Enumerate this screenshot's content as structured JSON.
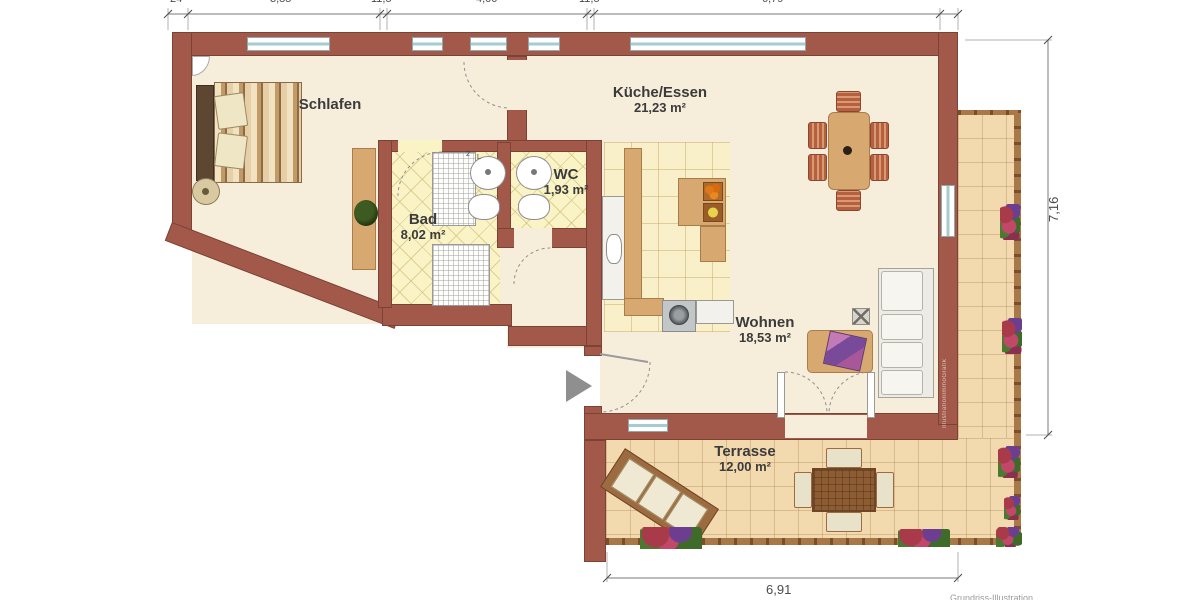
{
  "plan": {
    "type": "floorplan",
    "rooms": {
      "schlafen": {
        "name": "Schlafen",
        "area": ""
      },
      "kueche": {
        "name": "Küche/Essen",
        "area": "21,23 m²"
      },
      "wc": {
        "name": "WC",
        "area": "1,93 m²"
      },
      "bad": {
        "name": "Bad",
        "area": "8,02 m²"
      },
      "wohnen": {
        "name": "Wohnen",
        "area": "18,53 m²"
      },
      "terrasse": {
        "name": "Terrasse",
        "area": "12,00 m²"
      }
    },
    "dimensions": {
      "top": [
        "24",
        "3,85",
        "11,5",
        "4,00",
        "11,5",
        "6,79"
      ],
      "right": "7,16",
      "bottom": "6,91"
    },
    "annotations": {
      "watermark": "IllustrationImmoGrafik",
      "caption": "Grundriss-Illustration",
      "bath_marks": [
        "2",
        "L"
      ]
    },
    "colors": {
      "wall": "#a3594a",
      "floor": "#f6eedb",
      "bath_tile": "#f9f3c6",
      "kitchen_tile": "#f9efc8",
      "terrace_tile": "#f2d9ae"
    }
  }
}
